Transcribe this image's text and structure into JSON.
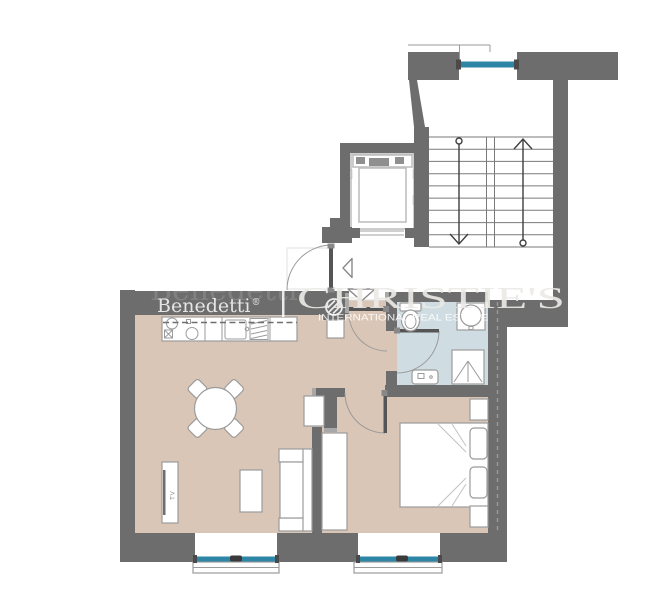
{
  "watermark": {
    "brand": "Benedetti",
    "registered": "®",
    "big_text": "CHRISTIE'S",
    "subtitle": "INTERNATIONAL REAL ESTATE"
  },
  "labels": {
    "tv": "TV"
  },
  "colors": {
    "wall": "#6d6d6d",
    "floor_main": "#d9c6b6",
    "floor_bath": "#cfdde3",
    "window_glass": "#2e86a6",
    "furniture_outline": "#9b9b9b",
    "elevator_lines": "#c0c0c0"
  }
}
